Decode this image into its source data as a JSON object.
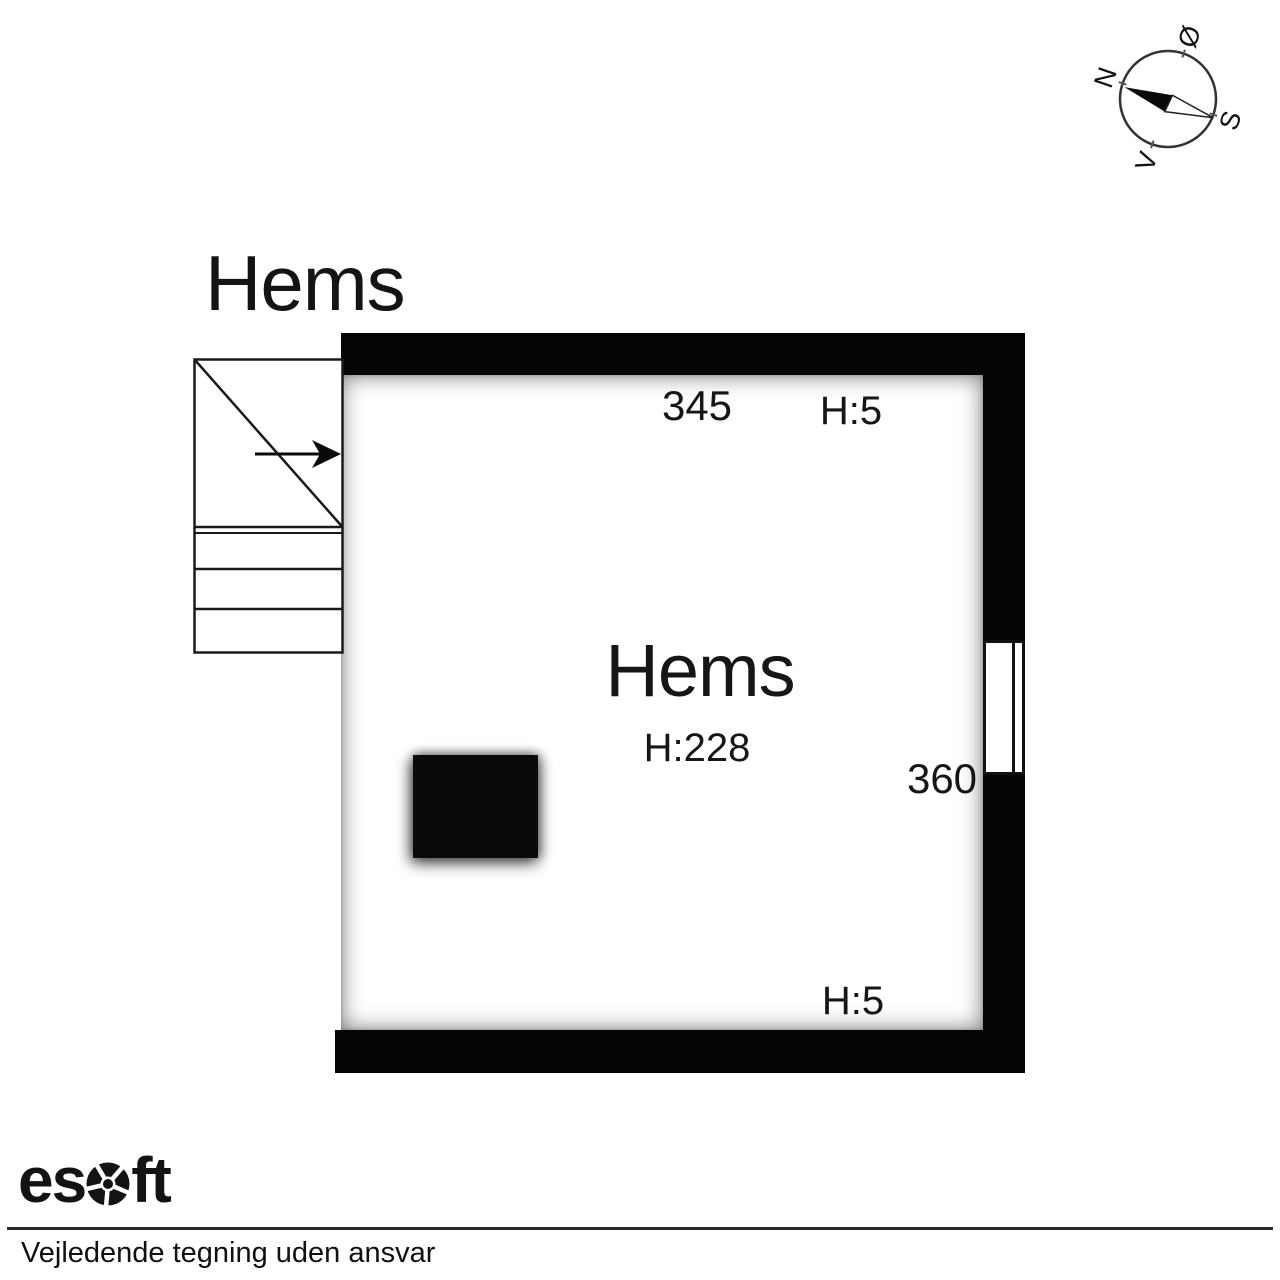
{
  "title": "Hems",
  "compass": {
    "labels": {
      "north": "N",
      "east": "Ø",
      "south": "S",
      "west": "V"
    }
  },
  "plan": {
    "room_label": "Hems",
    "room_height": "H:228",
    "dim_top": "345",
    "dim_right": "360",
    "ceiling_top": "H:5",
    "ceiling_bottom": "H:5"
  },
  "footer": {
    "logo_prefix": "es",
    "logo_suffix": "ft",
    "disclaimer": "Vejledende tegning uden ansvar"
  },
  "colors": {
    "wall": "#050505",
    "text": "#161616",
    "shadow": "rgba(0,0,0,0.5)"
  },
  "icons": {
    "compass": "compass-rose-icon",
    "logo_o": "esoft-gear-icon",
    "stairs_arrow": "stair-direction-arrow-icon"
  }
}
